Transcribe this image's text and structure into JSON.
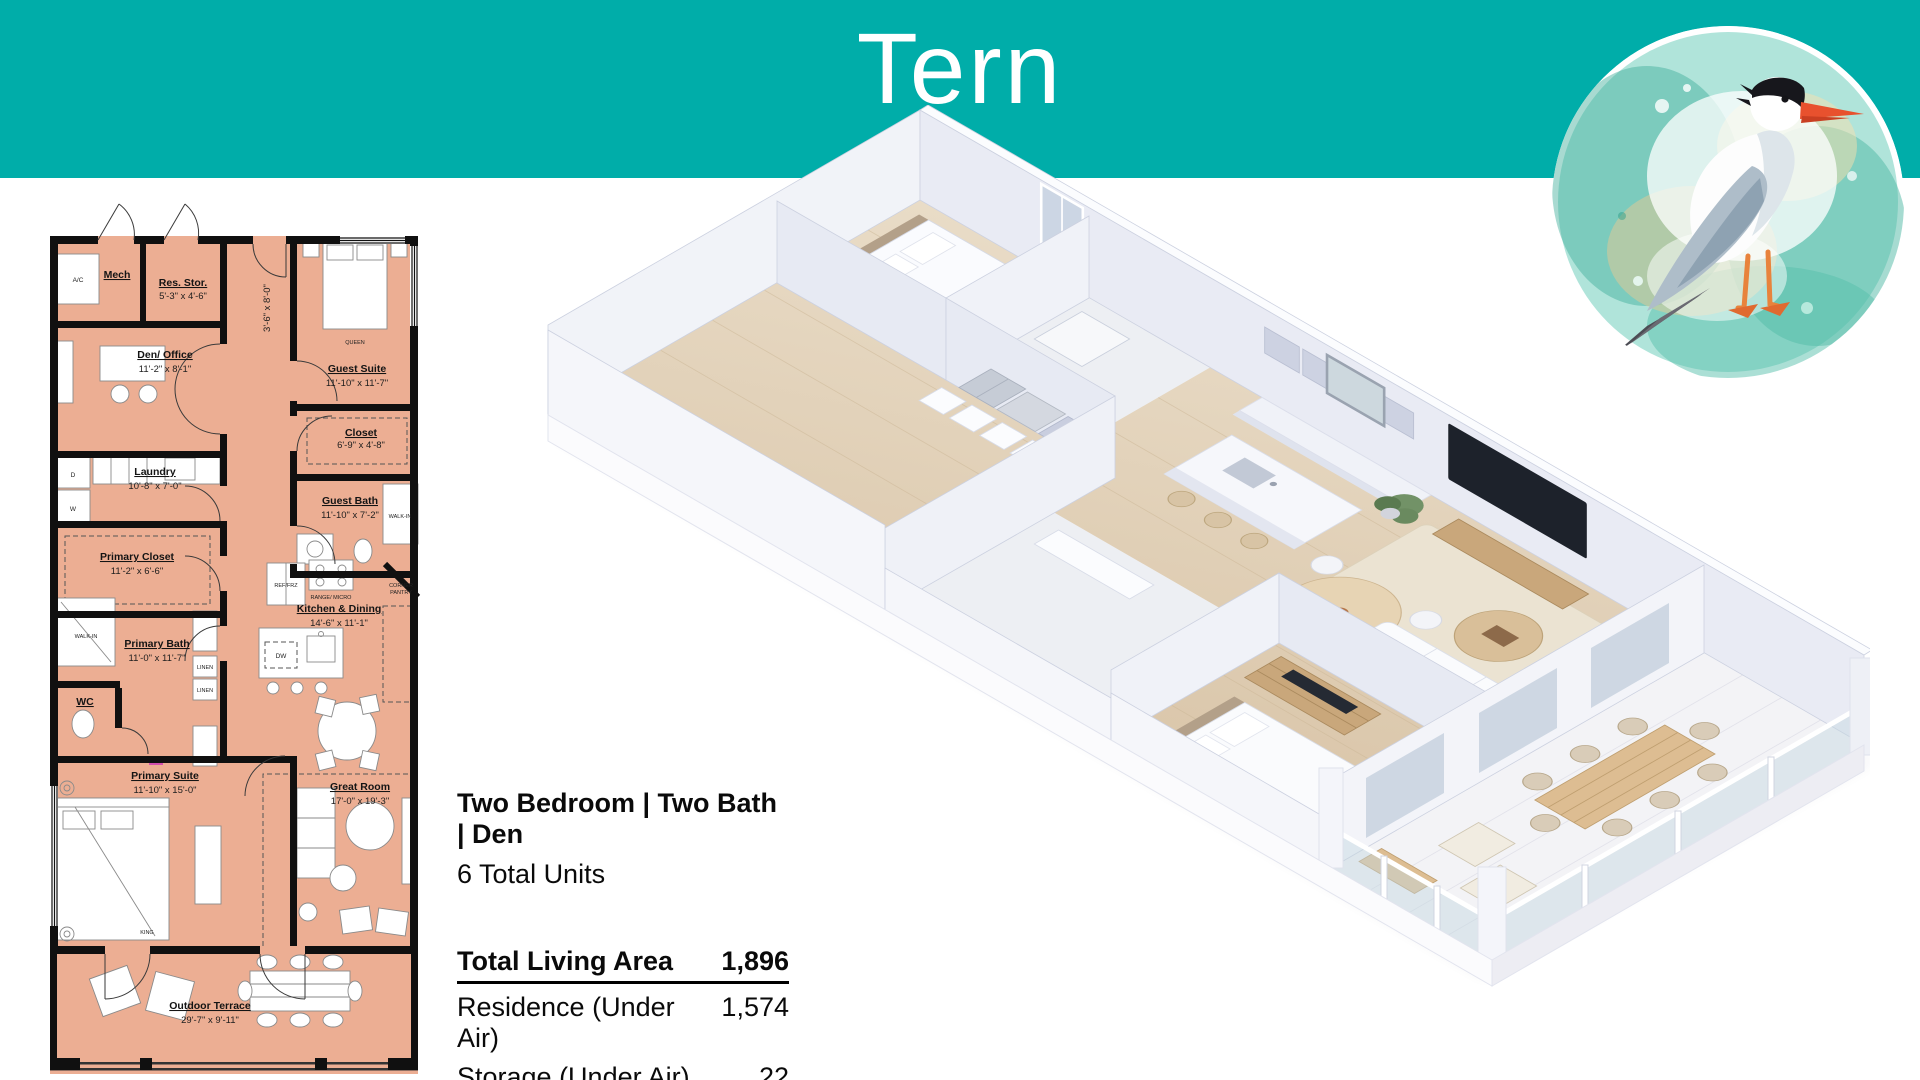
{
  "colors": {
    "header_teal": "#00ADA9",
    "plan_room_fill": "#ECAE93",
    "plan_wall": "#101010",
    "render_wall": "#EFF1F7",
    "render_wood_floor": "#E4D4BE",
    "accent_wood": "#C9A77B"
  },
  "header": {
    "title": "Tern"
  },
  "badge": {
    "icon": "tern-bird-watercolor"
  },
  "plan2d": {
    "rooms": [
      {
        "name": "Mech",
        "dims": ""
      },
      {
        "name": "Res. Stor.",
        "dims": "5'-3\" x 4'-6\""
      },
      {
        "name": "Den/ Office",
        "dims": "11'-2\" x 8'-1\""
      },
      {
        "name": "Guest Suite",
        "dims": "11'-10\" x 11'-7\""
      },
      {
        "name": "Closet",
        "dims": "6'-9\" x 4'-8\""
      },
      {
        "name": "Laundry",
        "dims": "10'-8\" x 7'-0\""
      },
      {
        "name": "Guest Bath",
        "dims": "11'-10\" x 7'-2\""
      },
      {
        "name": "Primary Closet",
        "dims": "11'-2\" x 6'-6\""
      },
      {
        "name": "Primary Bath",
        "dims": "11'-0\" x 11'-7\""
      },
      {
        "name": "WC",
        "dims": ""
      },
      {
        "name": "Kitchen & Dining",
        "dims": "14'-6\" x 11'-1\""
      },
      {
        "name": "Primary Suite",
        "dims": "11'-10\" x 15'-0\""
      },
      {
        "name": "Great Room",
        "dims": "17'-0\" x 19'-3\""
      },
      {
        "name": "Outdoor Terrace",
        "dims": "29'-7\" x 9'-11\""
      }
    ],
    "fixtures": {
      "ac": "A/C",
      "queen": "QUEEN",
      "king": "KING",
      "walk_in": "WALK-IN",
      "linen1": "LINEN",
      "linen2": "LINEN",
      "dryer": "D",
      "washer": "W",
      "ref": "REF/FRZ",
      "range": "RANGE/ MICRO",
      "dw": "DW",
      "pantry_line1": "CORNER",
      "pantry_line2": "PANTRY",
      "entry_door_dim": "3'-6\" x 8'-0\""
    }
  },
  "details": {
    "type_line": "Two Bedroom | Two Bath | Den",
    "units_line": "6 Total Units",
    "table": {
      "header_label": "Total Living Area",
      "header_value": "1,896",
      "rows": [
        {
          "label": "Residence (Under Air)",
          "value": "1,574"
        },
        {
          "label": "Storage (Under Air)",
          "value": "22"
        },
        {
          "label": "Terrace",
          "value": "300"
        }
      ]
    }
  }
}
